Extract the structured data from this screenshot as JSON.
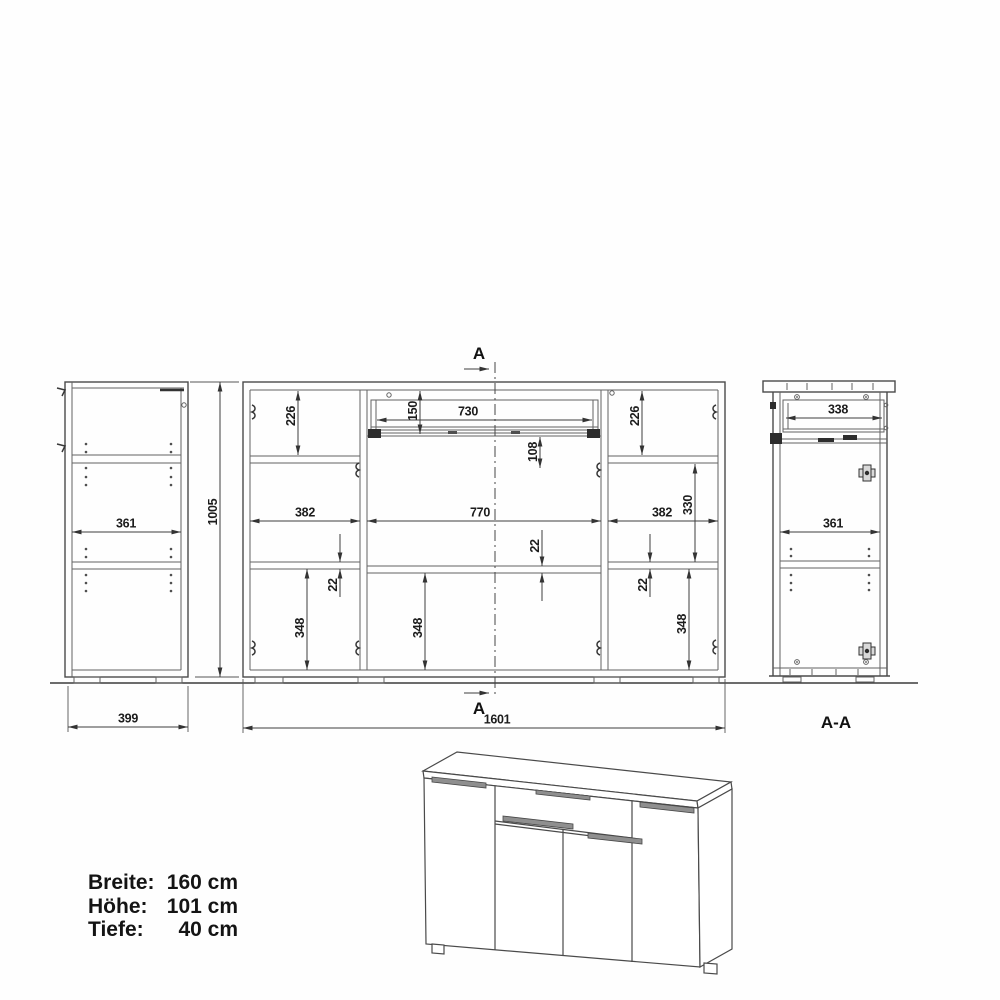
{
  "views": {
    "side": {
      "inner_width": "361",
      "height": "1005",
      "depth": "399"
    },
    "front": {
      "marker_top": "A",
      "marker_bottom": "A",
      "top_left": "226",
      "top_right": "226",
      "drawer_h": "150",
      "drawer_w": "730",
      "drawer_gap": "108",
      "w_left": "382",
      "w_center": "770",
      "w_right": "382",
      "right_open": "330",
      "shelf_l": "22",
      "shelf_c": "22",
      "shelf_r": "22",
      "bot_l": "348",
      "bot_c": "348",
      "bot_r": "348",
      "total_w": "1601"
    },
    "section": {
      "drawer_depth": "338",
      "inner_depth": "361",
      "title": "A-A"
    }
  },
  "specs": {
    "rows": [
      {
        "label": "Breite:",
        "value": "160 cm"
      },
      {
        "label": "Höhe:",
        "value": "101 cm"
      },
      {
        "label": "Tiefe:",
        "value": "40 cm"
      }
    ]
  }
}
